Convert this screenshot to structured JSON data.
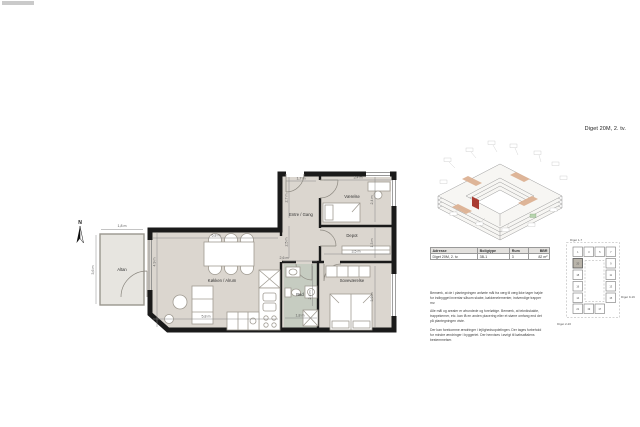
{
  "page": {
    "title": "Diget 20M, 2. tv."
  },
  "floorplan": {
    "north_label": "N",
    "rooms": {
      "altan": "Altan",
      "koekken": "Køkken / Alrum",
      "entre": "Entre / Gang",
      "vaerelse": "Værelse",
      "depot": "Depot",
      "bad": "Bad",
      "sove": "Soveværelse"
    },
    "dims": {
      "altan_w": "1,8 m",
      "altan_h": "3,6 m",
      "koekken_w": "6,8 m",
      "koekken_h": "4,9 m",
      "koekken_b": "5,8 m",
      "passage": "2,6 m",
      "entre_w": "1,7 m",
      "entre_h1": "2,7 m",
      "entre_h2": "2,5 m",
      "vaerelse_w": "3,4 m",
      "vaerelse_h": "2,4 m",
      "depot_w": "3,5 m",
      "depot_h": "1,3 m",
      "sove_h": "3,9 m",
      "bad_h": "2,4 m",
      "bad_w": "1,8 m"
    }
  },
  "info_table": {
    "headers": [
      "Adresse",
      "Boligtype",
      "Rum",
      "BBR"
    ],
    "rows": [
      [
        "Diget 20M, 2. tv.",
        "3B-1",
        "3",
        "82 m²"
      ]
    ]
  },
  "disclaimer": {
    "p1": "Bemærk, at de i plantegningen anførte mål fra væg til væg ikke tager højde for indbygget inventar såsom skabe, køkkenelementer, indvendige trapper mv.",
    "p2": "Alle mål og arealer er afrundede og foreløbige. Bemærk, at teknikskakte, trappekerner, etc. kan få en anden placering eller et større omfang end det på plantegningen viste.",
    "p3": "Der kan forekomme ændringer i lejlighedsopdelingen. Der tages forbehold for mindre ændringer i byggeriet. Der henvises i øvrigt til købsaftalens bestemmelser."
  },
  "site_plan": {
    "labels": {
      "top": "Diget 1-7",
      "right": "Diget 9-19",
      "left": "Diget 2-20"
    },
    "blocks": [
      "1",
      "3",
      "5",
      "7",
      "9",
      "11",
      "13",
      "15",
      "17",
      "19",
      "21",
      "20",
      "18",
      "16",
      "14"
    ],
    "highlighted_block": "20"
  },
  "colors": {
    "wall": "#1a1a1a",
    "floor": "#dbd6cf",
    "balcony": "#e7e5e0",
    "bath": "#c6ccc1",
    "accent_red": "#a93c32",
    "accent_tan": "#ddb294",
    "accent_green": "#b7d4ae"
  }
}
